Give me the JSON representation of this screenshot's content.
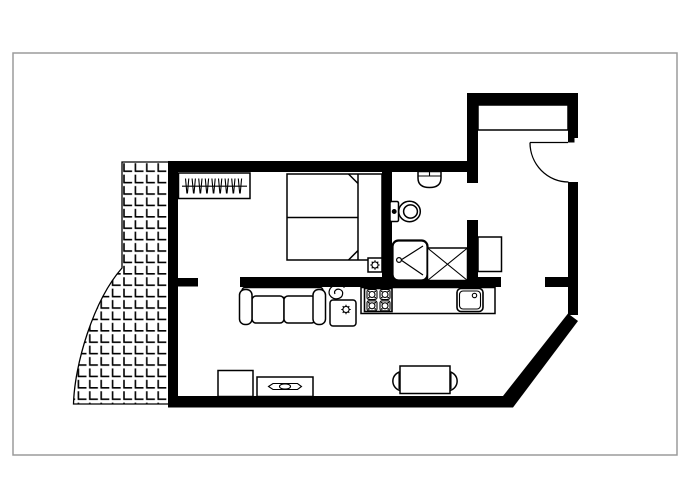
{
  "canvas": {
    "width": 700,
    "height": 500,
    "background": "#ffffff"
  },
  "frame": {
    "stroke": "#9b9b9b"
  },
  "colors": {
    "wall": "#000000",
    "line": "#000000",
    "fill": "#ffffff"
  },
  "plan": {
    "name": "studio-apartment-floor-plan",
    "doors": [
      "entrance-door-swing",
      "bedroom-opening",
      "bathroom-opening",
      "living-room-opening"
    ],
    "rooms": [
      {
        "name": "bedroom",
        "furniture": [
          "wardrobe-with-hangers",
          "double-bed",
          "bedside-table-lamp"
        ]
      },
      {
        "name": "bathroom",
        "furniture": [
          "washbasin",
          "toilet",
          "shower-cabin",
          "washing-machine"
        ]
      },
      {
        "name": "entrance-hall",
        "furniture": [
          "built-in-closet",
          "hall-cabinet",
          "entrance-door"
        ]
      },
      {
        "name": "kitchen",
        "furniture": [
          "countertop",
          "stove-four-burners",
          "kitchen-sink"
        ]
      },
      {
        "name": "living-room",
        "furniture": [
          "sofa",
          "potted-plant",
          "side-table-with-lamp",
          "tv-cabinet",
          "tv-on-stand",
          "dining-table",
          "dining-chair-left",
          "dining-chair-right"
        ]
      },
      {
        "name": "balcony",
        "furniture": [
          "tiled-floor"
        ]
      }
    ]
  }
}
